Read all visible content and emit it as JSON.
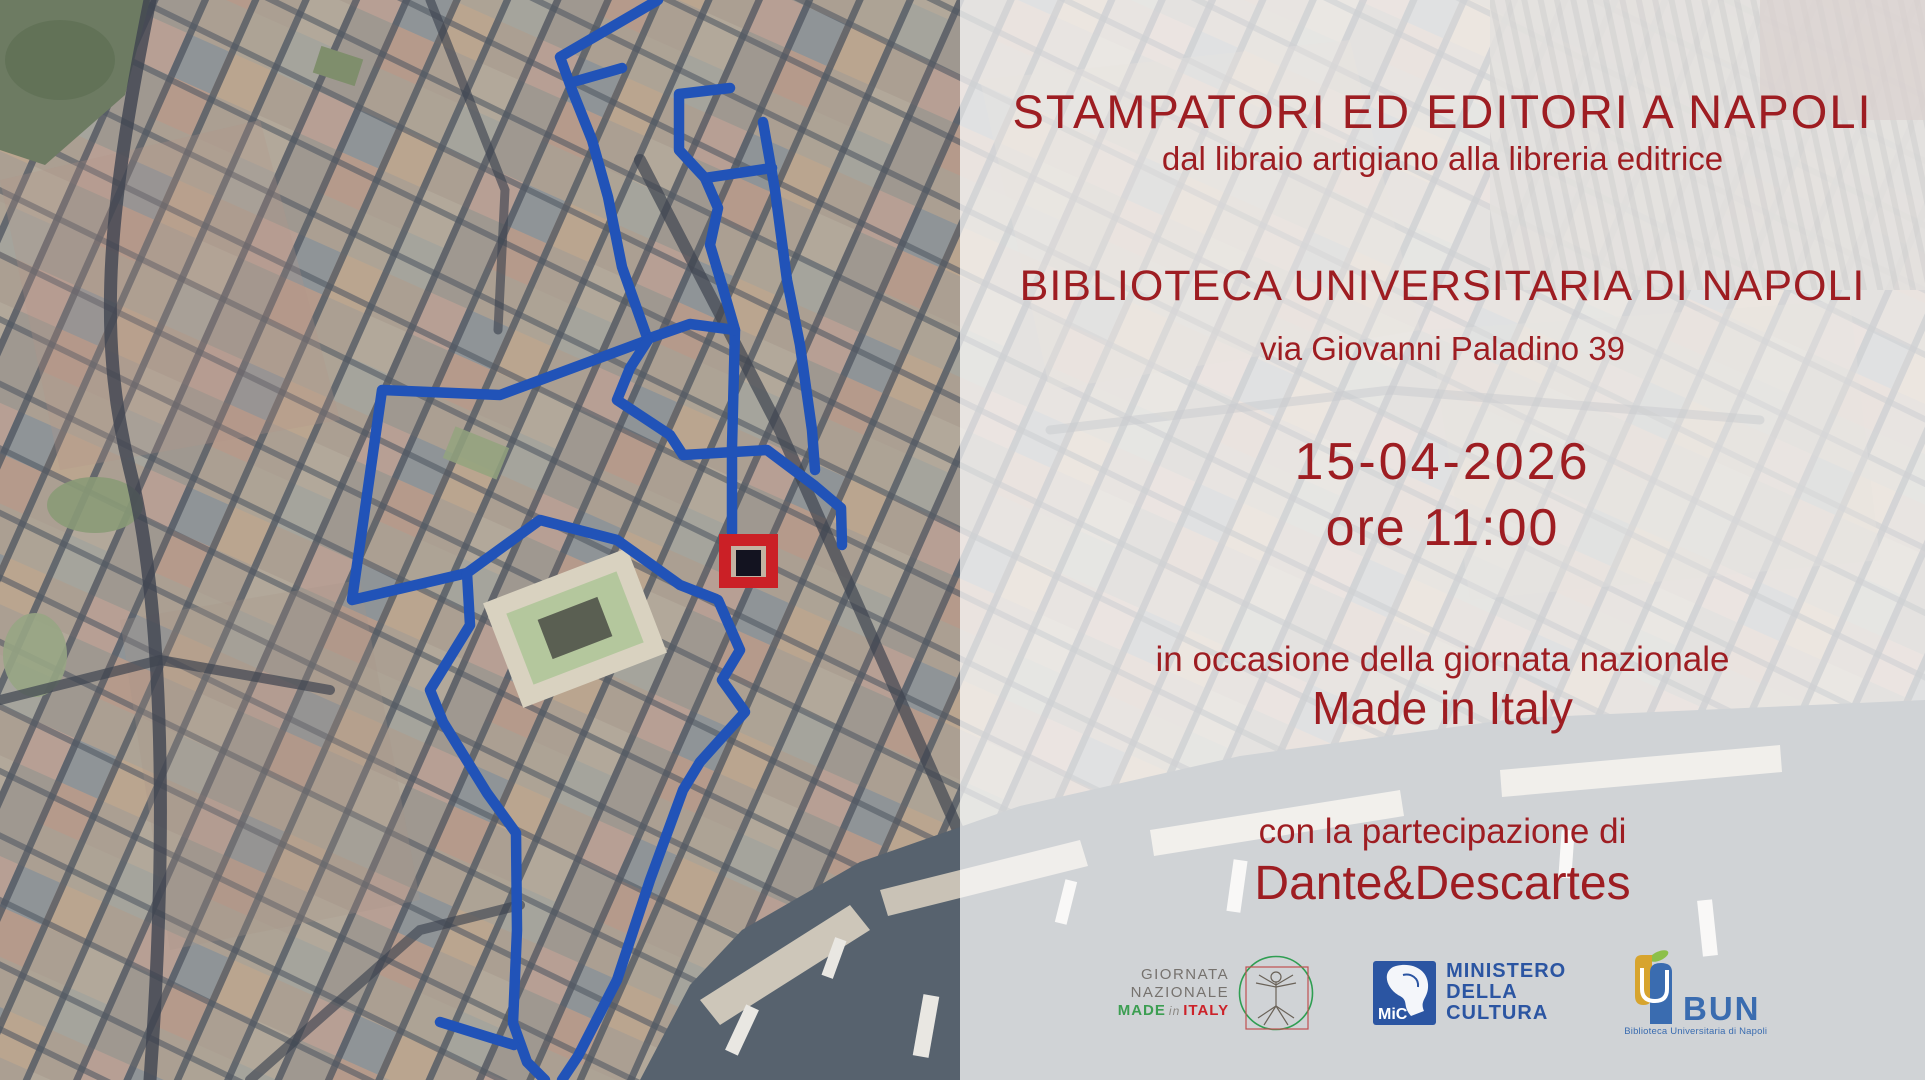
{
  "event": {
    "title": "STAMPATORI ED EDITORI A NAPOLI",
    "subtitle": "dal libraio artigiano alla libreria editrice",
    "venue": "BIBLIOTECA UNIVERSITARIA DI NAPOLI",
    "address": "via Giovanni Paladino 39",
    "date": "15-04-2026",
    "time": "ore 11:00",
    "occasion_line": "in occasione della giornata nazionale",
    "occasion_name": "Made in Italy",
    "participation_line": "con la partecipazione di",
    "guest": "Dante&Descartes"
  },
  "logos": {
    "giornata": {
      "line1": "GIORNATA",
      "line2": "NAZIONALE",
      "made": "MADE",
      "conj": "in",
      "italy": "ITALY"
    },
    "mic": {
      "acronym": "MiC",
      "line1": "MINISTERO",
      "line2": "DELLA",
      "line3": "CULTURA"
    },
    "bun": {
      "acronym": "BUN",
      "caption": "Biblioteca Universitaria di Napoli"
    }
  },
  "map": {
    "route_color": "#2153b8",
    "marker_color": "#cb2026",
    "text_red": "#9e1d22",
    "overlay": "rgba(255,255,255,0.72)"
  }
}
